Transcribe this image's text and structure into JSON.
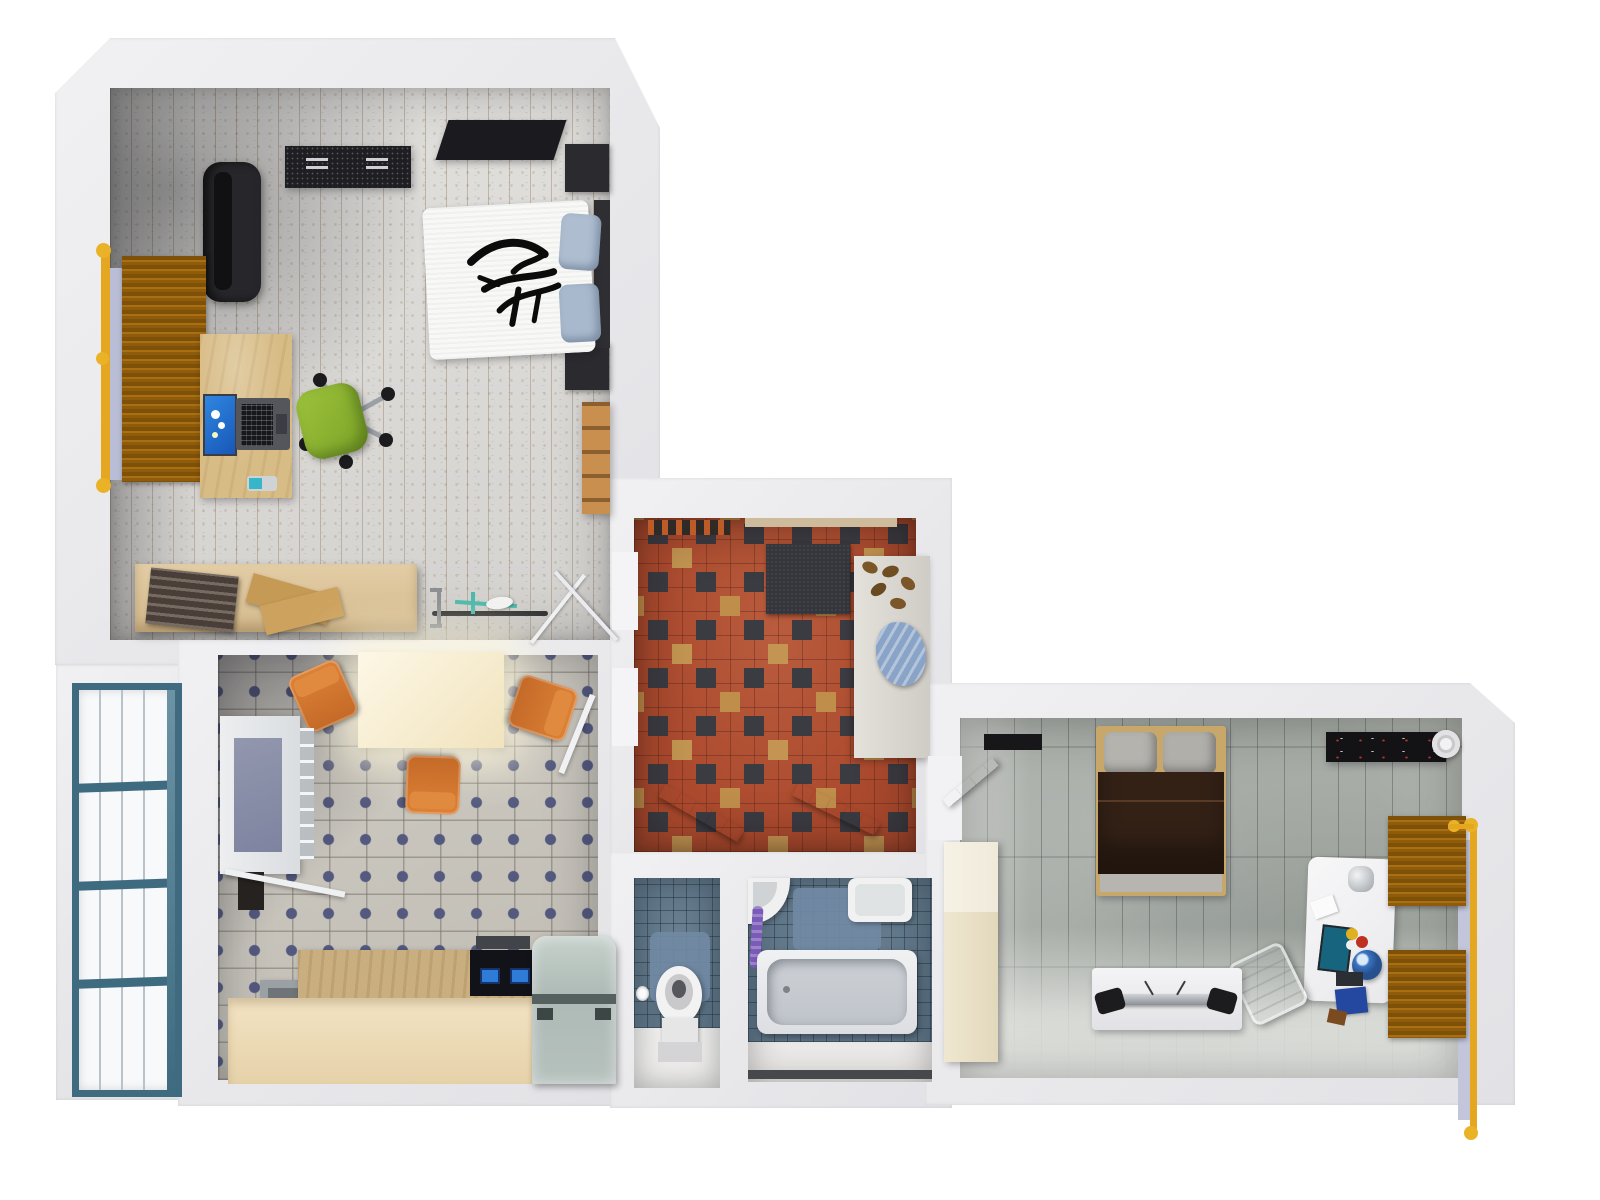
{
  "scene": {
    "title": "3D top-down floor plan render of an apartment",
    "type": "3d-floorplan-render",
    "background": "#ffffff",
    "wall_color": "#e9e9ec"
  },
  "colors": {
    "plank_light_floor": "#dcdbd8",
    "kitchen_tile": "#c7c3bb",
    "kitchen_tile_dot": "#53597f",
    "hall_tile_terracotta": "#ac4a2e",
    "hall_tile_dark": "#3b3b42",
    "hall_tile_tan": "#c49552",
    "gray_plank_floor": "#a2a7a2",
    "bath_tile_blue": "#5d7486",
    "radiator_amber": "#a96f12",
    "radiator_pipe_yellow": "#e5a71f",
    "window_frame_teal": "#3e6b80",
    "desk_wood": "#d8bc86",
    "chair_green": "#8bb02f",
    "chair_orange": "#d0752e",
    "bed_blanket_brown": "#332116",
    "appliance_teal_gray": "#b6c1bd",
    "towel_purple": "#7a5bb8",
    "mat_blue": "#7189a4"
  },
  "rooms": [
    {
      "id": "bedroom-office",
      "name": "Bedroom / office with light plank floor",
      "furniture": [
        "black wall dresser",
        "black tv panel",
        "black lounge couch",
        "window radiator with yellow pipes",
        "wood desk with laptop showing daisy wallpaper",
        "green swivel chair",
        "double bed with white tribal duvet and blue pillows",
        "two dark nightstands",
        "wooden ladder chair",
        "sideboard with towels and cardboard",
        "bicycle",
        "drying rack"
      ]
    },
    {
      "id": "kitchen",
      "name": "Kitchen with beige dot tiles",
      "furniture": [
        "bright dining table",
        "three orange chairs",
        "wall window with towel ladder",
        "dark wall heater",
        "white rail",
        "gray bin",
        "L-shaped wooden counter",
        "black cooktop with blue burners",
        "teal-gray fridge"
      ]
    },
    {
      "id": "hallway",
      "name": "Hallway with terracotta checker tiles",
      "furniture": [
        "entry doormat",
        "dark gray rug",
        "white shoe cabinet",
        "brown shoes",
        "blue cloth",
        "two open white doors"
      ]
    },
    {
      "id": "wc",
      "name": "WC with blue tiles",
      "furniture": [
        "toilet",
        "blue mat",
        "toilet paper roll"
      ]
    },
    {
      "id": "bathroom",
      "name": "Bathroom with blue tiles",
      "furniture": [
        "bathtub",
        "corner sink",
        "laundry basin",
        "purple towel",
        "blue mat",
        "dark threshold"
      ]
    },
    {
      "id": "bedroom-2",
      "name": "Bedroom with gray rustic plank floor",
      "furniture": [
        "double bed with brown blanket",
        "black wall shelf with stereo",
        "white paper roll",
        "white desk with monitor, globe and books",
        "white chair",
        "two amber radiators with yellow pipe",
        "white tv lowboard with speakers",
        "beige wardrobe",
        "open white door"
      ]
    },
    {
      "id": "balcony-window",
      "name": "Floor-to-ceiling window with teal frame",
      "furniture": [
        "glazed panel grid"
      ]
    }
  ]
}
